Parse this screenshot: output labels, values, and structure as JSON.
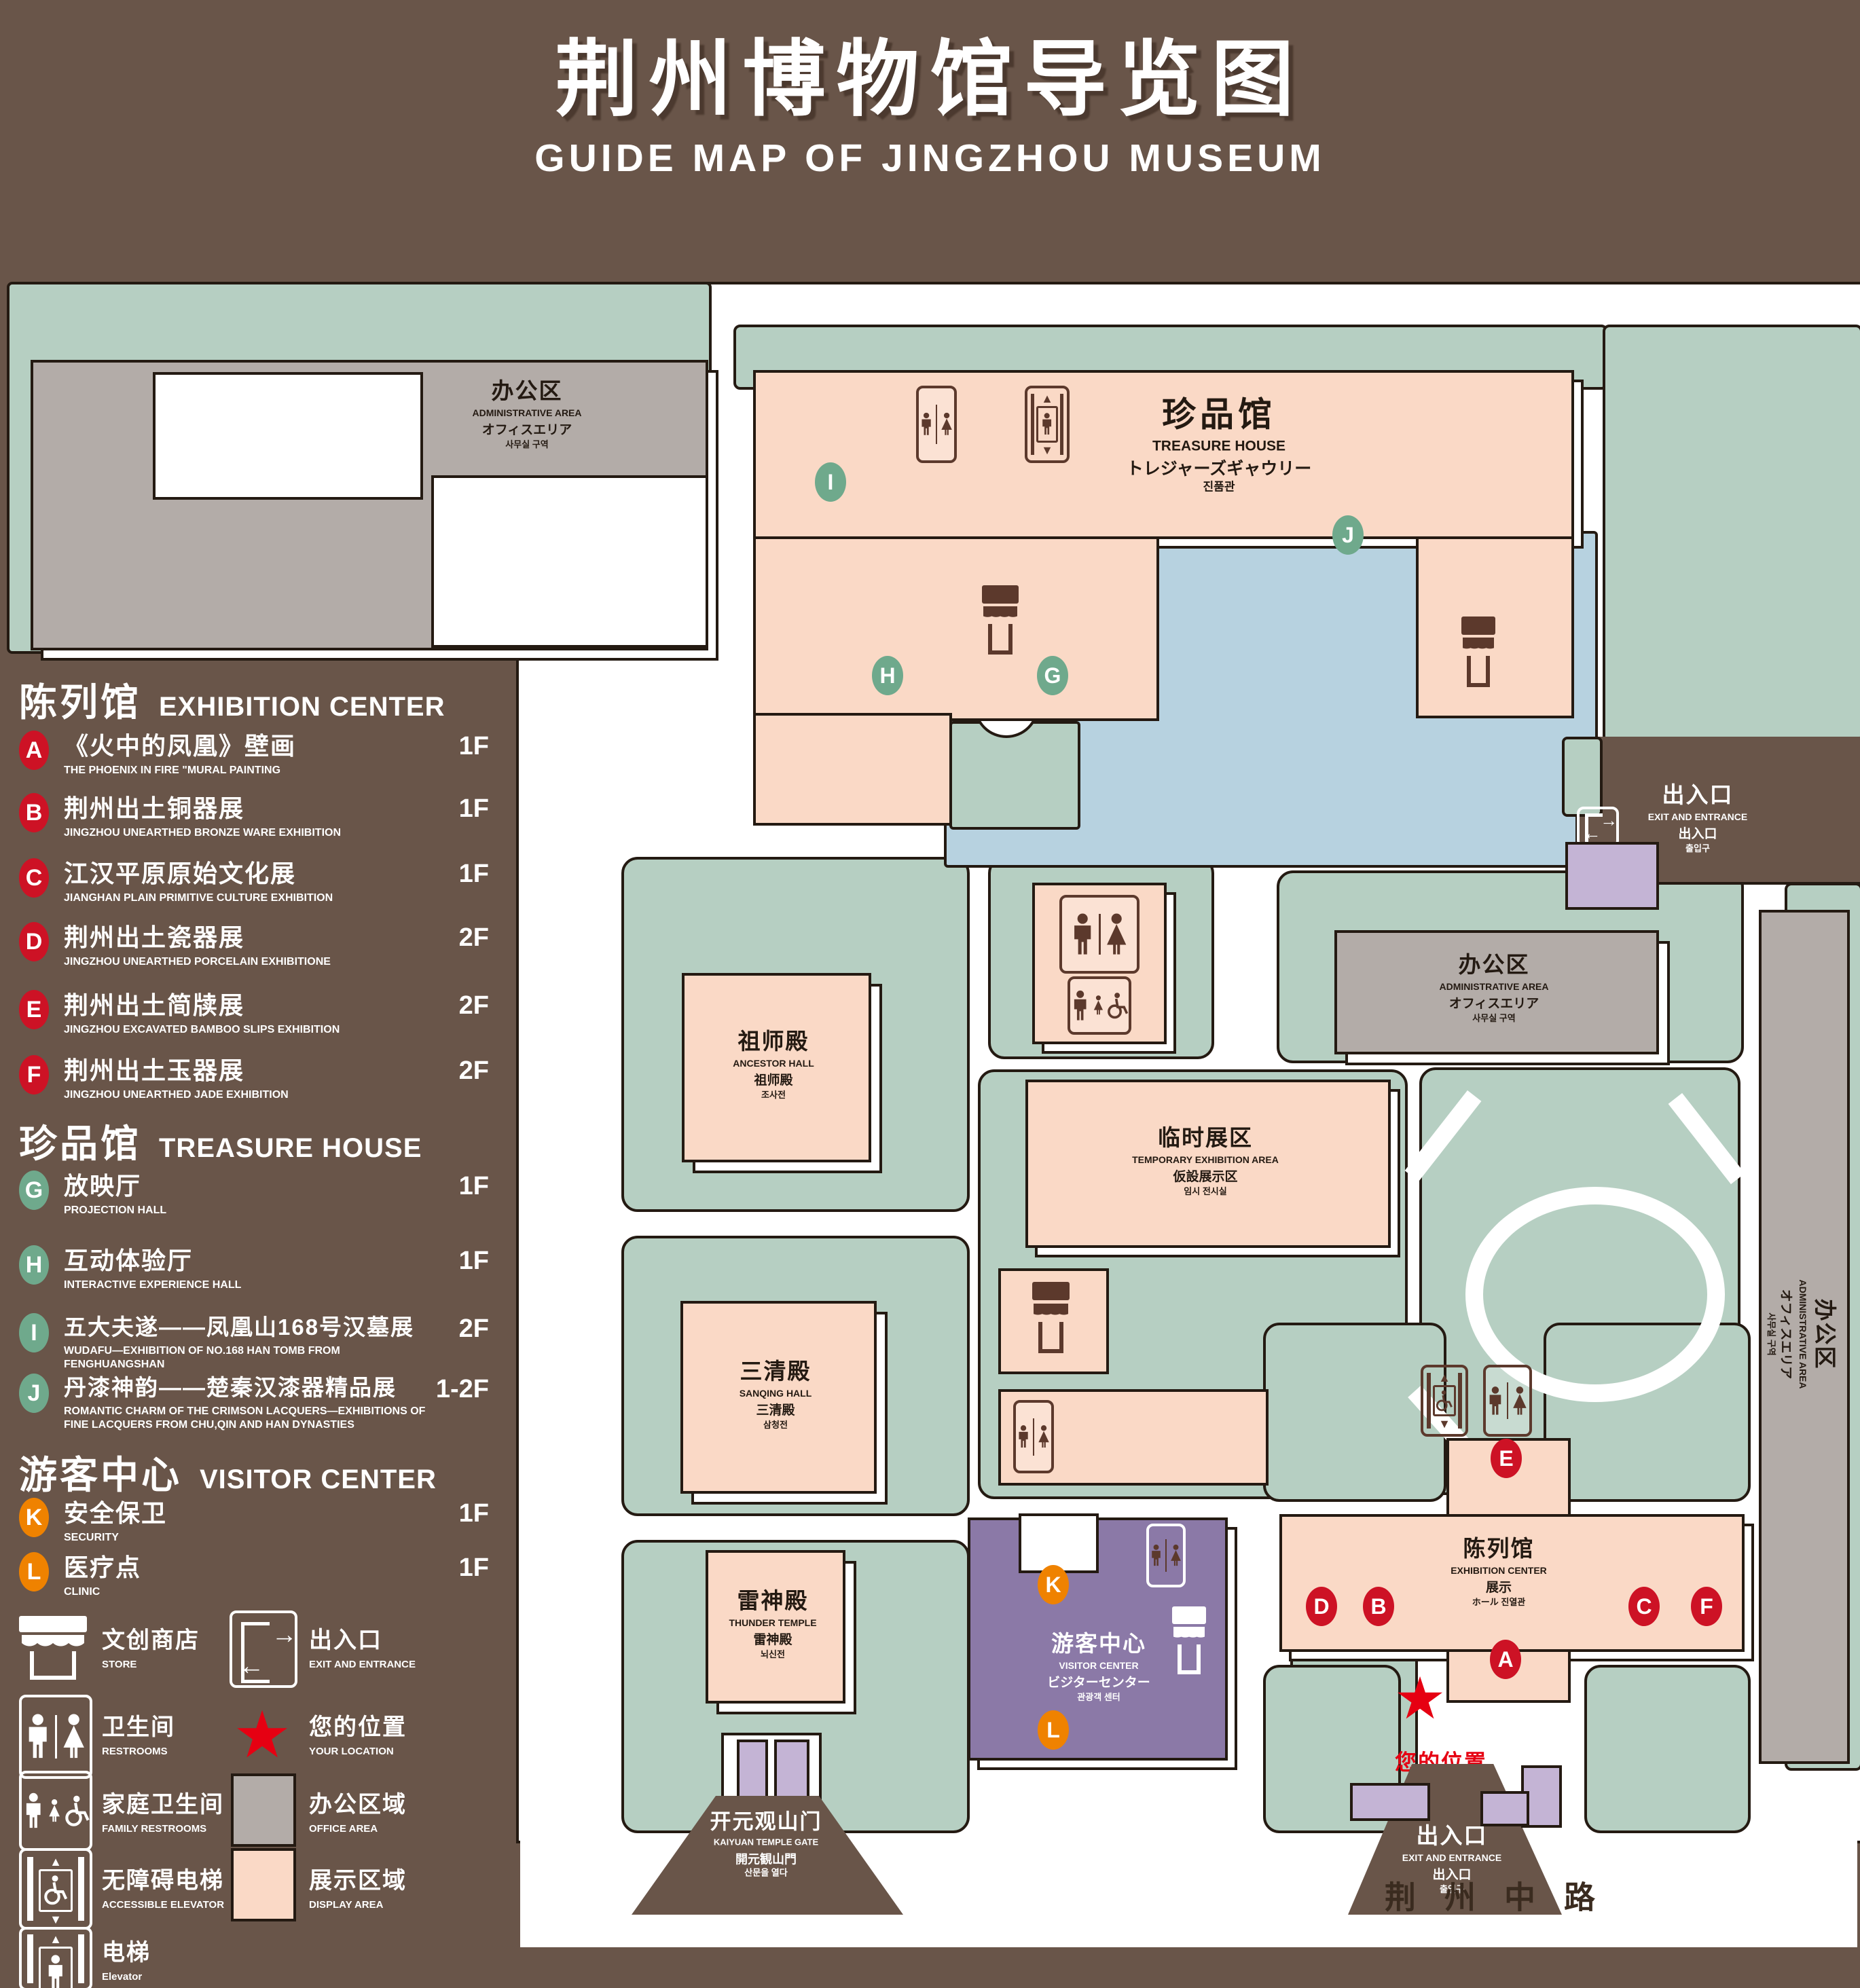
{
  "title": {
    "zh": "荆州博物馆导览图",
    "en": "GUIDE MAP OF JINGZHOU MUSEUM"
  },
  "colors": {
    "background": "#695549",
    "lawn": "#b6cfc2",
    "display_area": "#fad9c6",
    "office_area": "#b3aca8",
    "water": "#b7d2e0",
    "visitor_center": "#8b79a7",
    "light_purple": "#c4b4d5",
    "badge_red": "#cd1225",
    "badge_green": "#6fa98c",
    "badge_orange": "#ef8200",
    "icon_brown": "#5c392c",
    "location_red": "#e60012"
  },
  "legend": {
    "sections": [
      {
        "zh": "陈列馆",
        "en": "EXHIBITION CENTER",
        "items": [
          {
            "letter": "A",
            "zh": "《火中的凤凰》壁画",
            "en": "THE PHOENIX IN FIRE \"MURAL PAINTING",
            "floor": "1F"
          },
          {
            "letter": "B",
            "zh": "荆州出土铜器展",
            "en": "JINGZHOU UNEARTHED BRONZE WARE EXHIBITION",
            "floor": "1F"
          },
          {
            "letter": "C",
            "zh": "江汉平原原始文化展",
            "en": "JIANGHAN PLAIN PRIMITIVE CULTURE EXHIBITION",
            "floor": "1F"
          },
          {
            "letter": "D",
            "zh": "荆州出土瓷器展",
            "en": "JINGZHOU UNEARTHED PORCELAIN EXHIBITIONE",
            "floor": "2F"
          },
          {
            "letter": "E",
            "zh": "荆州出土简牍展",
            "en": "JINGZHOU EXCAVATED BAMBOO SLIPS EXHIBITION",
            "floor": "2F"
          },
          {
            "letter": "F",
            "zh": "荆州出土玉器展",
            "en": "JINGZHOU UNEARTHED JADE EXHIBITION",
            "floor": "2F"
          }
        ]
      },
      {
        "zh": "珍品馆",
        "en": "TREASURE HOUSE",
        "items": [
          {
            "letter": "G",
            "zh": "放映厅",
            "en": "PROJECTION HALL",
            "floor": "1F"
          },
          {
            "letter": "H",
            "zh": "互动体验厅",
            "en": "INTERACTIVE EXPERIENCE HALL",
            "floor": "1F"
          },
          {
            "letter": "I",
            "zh": "五大夫遂——凤凰山168号汉墓展",
            "en": "WUDAFU—EXHIBITION OF NO.168 HAN TOMB FROM FENGHUANGSHAN",
            "floor": "2F"
          },
          {
            "letter": "J",
            "zh": "丹漆神韵——楚秦汉漆器精品展",
            "en": "ROMANTIC CHARM OF THE CRIMSON LACQUERS—EXHIBITIONS OF FINE LACQUERS FROM CHU,QIN AND HAN DYNASTIES",
            "floor": "1-2F"
          }
        ]
      },
      {
        "zh": "游客中心",
        "en": "VISITOR CENTER",
        "items": [
          {
            "letter": "K",
            "zh": "安全保卫",
            "en": "SECURITY",
            "floor": "1F"
          },
          {
            "letter": "L",
            "zh": "医疗点",
            "en": "CLINIC",
            "floor": "1F"
          }
        ]
      }
    ],
    "symbols": [
      {
        "zh": "文创商店",
        "en": "STORE"
      },
      {
        "zh": "出入口",
        "en": "EXIT AND ENTRANCE"
      },
      {
        "zh": "卫生间",
        "en": "RESTROOMS"
      },
      {
        "zh": "您的位置",
        "en": "YOUR LOCATION"
      },
      {
        "zh": "家庭卫生间",
        "en": "FAMILY RESTROOMS"
      },
      {
        "zh": "办公区域",
        "en": "OFFICE AREA"
      },
      {
        "zh": "无障碍电梯",
        "en": "ACCESSIBLE ELEVATOR"
      },
      {
        "zh": "展示区域",
        "en": "DISPLAY AREA"
      },
      {
        "zh": "电梯",
        "en": "Elevator"
      }
    ]
  },
  "map": {
    "office": {
      "zh": "办公区",
      "en": "ADMINISTRATIVE AREA",
      "l3": "オフィスエリア",
      "l4": "사무실 구역"
    },
    "treasure": {
      "zh": "珍品馆",
      "en": "TREASURE HOUSE",
      "l3": "トレジャーズギャウリー",
      "l4": "진품관"
    },
    "ancestor": {
      "zh": "祖师殿",
      "en": "ANCESTOR HALL",
      "l3": "祖师殿",
      "l4": "조사전"
    },
    "sanqing": {
      "zh": "三清殿",
      "en": "SANQING HALL",
      "l3": "三清殿",
      "l4": "삼청전"
    },
    "thunder": {
      "zh": "雷神殿",
      "en": "THUNDER TEMPLE",
      "l3": "雷神殿",
      "l4": "뇌신전"
    },
    "temporary": {
      "zh": "临时展区",
      "en": "TEMPORARY EXHIBITION AREA",
      "l3": "仮設展示区",
      "l4": "임시 전시실"
    },
    "exhibition": {
      "zh": "陈列馆",
      "en": "EXHIBITION CENTER",
      "l3": "展示",
      "l4": "ホール 진열관"
    },
    "visitor": {
      "zh": "游客中心",
      "en": "VISITOR CENTER",
      "l3": "ビジターセンター",
      "l4": "관광객 센터"
    },
    "exit": {
      "zh": "出入口",
      "en": "EXIT AND ENTRANCE",
      "l3": "出入口",
      "l4": "출입구"
    },
    "gate": {
      "zh": "开元观山门",
      "en": "KAIYUAN TEMPLE GATE",
      "l3": "開元観山門",
      "l4": "산문을 열다"
    },
    "road": "荆州中路",
    "your_location": "您的位置",
    "markers": {
      "a": "A",
      "b": "B",
      "c": "C",
      "d": "D",
      "e": "E",
      "f": "F",
      "g": "G",
      "h": "H",
      "i": "I",
      "j": "J",
      "k": "K",
      "l": "L"
    }
  }
}
